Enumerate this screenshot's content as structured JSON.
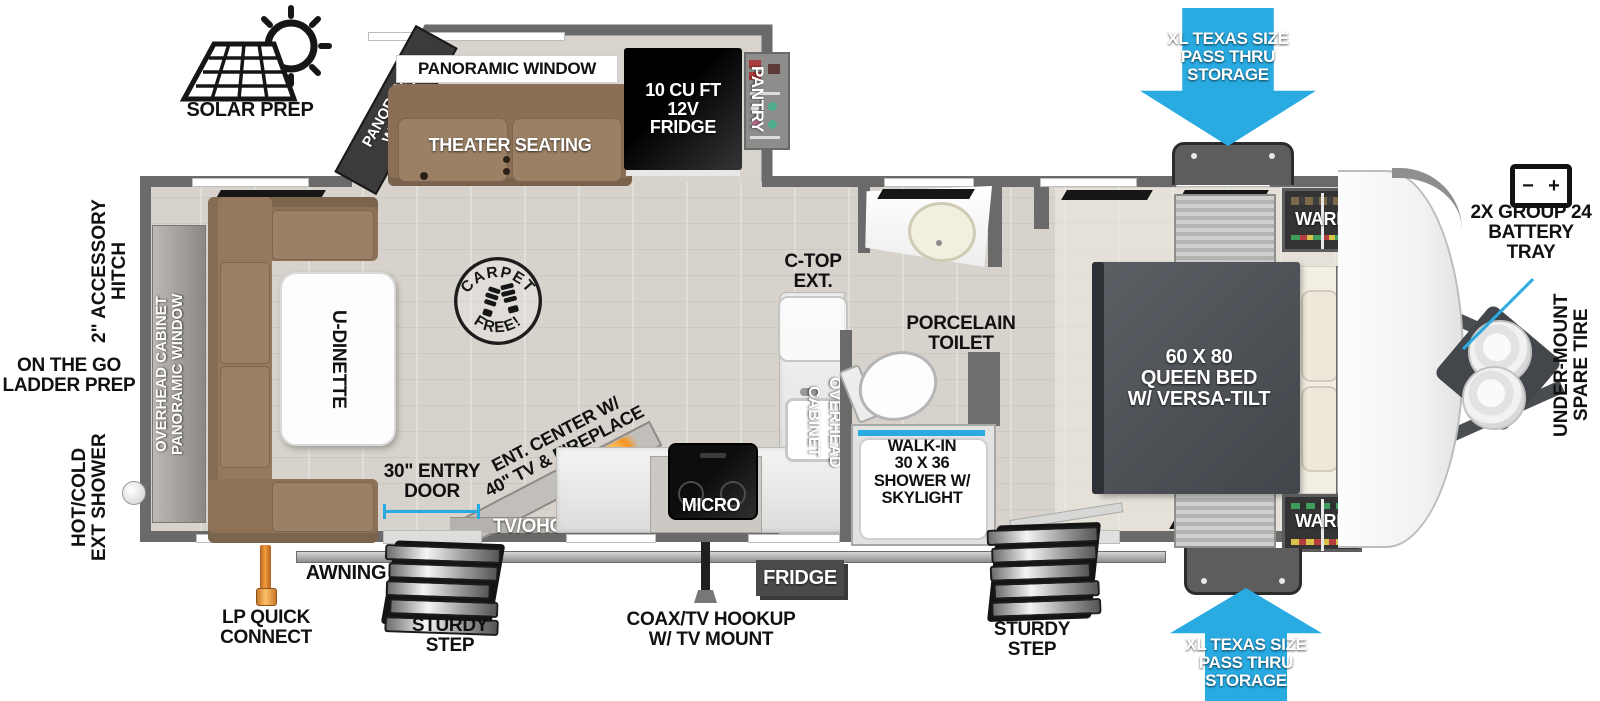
{
  "colors": {
    "accent_blue": "#29ABE2",
    "wall_gray": "#6A6A6A",
    "fireplace_orange": "#F7931E",
    "sofa_brown": "#94795F",
    "bed_gray": "#4E5257"
  },
  "solar": {
    "label": "SOLAR PREP"
  },
  "slideout": {
    "window_side": "PANORAMIC\nWINDOW",
    "window_top": "PANORAMIC WINDOW",
    "theater": "THEATER SEATING",
    "fridge12v": "10 CU FT\n12V\nFRIDGE",
    "pantry": "PANTRY"
  },
  "living": {
    "wall_cabinet": "OVERHEAD CABINET\nPANORAMIC WINDOW",
    "dinette": "U-DINETTE",
    "carpet_top": "CARPET",
    "carpet_bottom": "FREE!"
  },
  "kitchen": {
    "ctop": "C-TOP\nEXT.",
    "overhead": "OVERHEAD\nCABINET",
    "micro": "MICRO",
    "ent_center": "ENT. CENTER W/\n40\" TV & FIREPLACE",
    "tv_ohc": "TV/OHC"
  },
  "bath": {
    "toilet": "PORCELAIN\nTOILET",
    "shower": "WALK-IN\n30 X 36\nSHOWER W/\nSKYLIGHT"
  },
  "bedroom": {
    "bed": "60 X 80\nQUEEN BED\nW/ VERSA-TILT",
    "overhead": "OVERHEAD CABINETS",
    "ward_top": "WARD",
    "ward_bottom": "WARD"
  },
  "storage": {
    "top": "XL TEXAS SIZE\nPASS THRU\nSTORAGE",
    "bottom": "XL TEXAS SIZE\nPASS THRU\nSTORAGE"
  },
  "front": {
    "battery": "2X GROUP 24\nBATTERY\nTRAY",
    "battery_minus": "−",
    "battery_plus": "+",
    "spare": "UNDER-MOUNT\nSPARE TIRE"
  },
  "rear": {
    "hitch": "2\" ACCESSORY\nHITCH",
    "ladder": "ON THE GO\nLADDER PREP",
    "ext_shower": "HOT/COLD\nEXT SHOWER"
  },
  "exterior": {
    "awning": "AWNING",
    "lp": "LP QUICK\nCONNECT",
    "step1": "STURDY\nSTEP",
    "step2": "STURDY\nSTEP",
    "coax": "COAX/TV HOOKUP\nW/ TV MOUNT",
    "fridge": "FRIDGE",
    "entry": "30\" ENTRY\nDOOR"
  }
}
